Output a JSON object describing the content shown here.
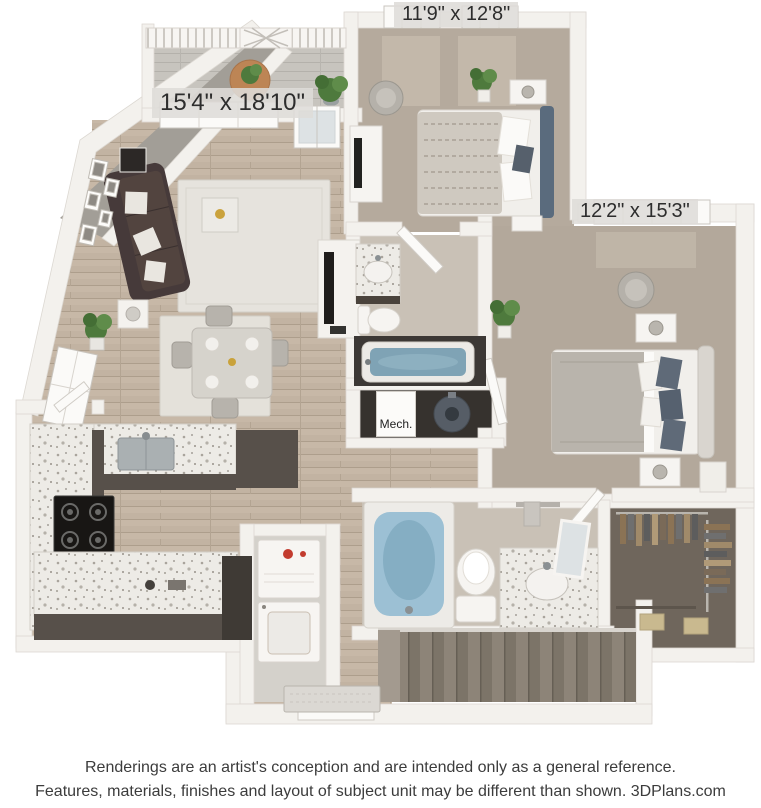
{
  "floorplan": {
    "labels": {
      "bedroom1_dims": "11'9\" x 12'8\"",
      "living_dims": "15'4\" x 18'10\"",
      "bedroom2_dims": "12'2\" x 15'3\"",
      "mech_room": "Mech."
    },
    "colors": {
      "wall": "#f3f1ed",
      "wood_floor": "#c2b3a2",
      "carpet": "#b5aa9d",
      "bath_tile": "#c9c1b6",
      "granite": "#edebe6",
      "cabinet_dark": "#57504a",
      "sofa_dark": "#463a3a",
      "tub_blue": "#9cc0d4",
      "stairs": "#857c71",
      "closet_floor": "#6f665c",
      "plant_green": "#4e7a3d",
      "mech_floor": "#36322e",
      "accent_red": "#c23b2e"
    }
  },
  "footer": {
    "line1": "Renderings are an artist's conception and are intended only as a general reference.",
    "line2": "Features, materials, finishes and layout of subject unit may be different than shown. 3DPlans.com"
  }
}
